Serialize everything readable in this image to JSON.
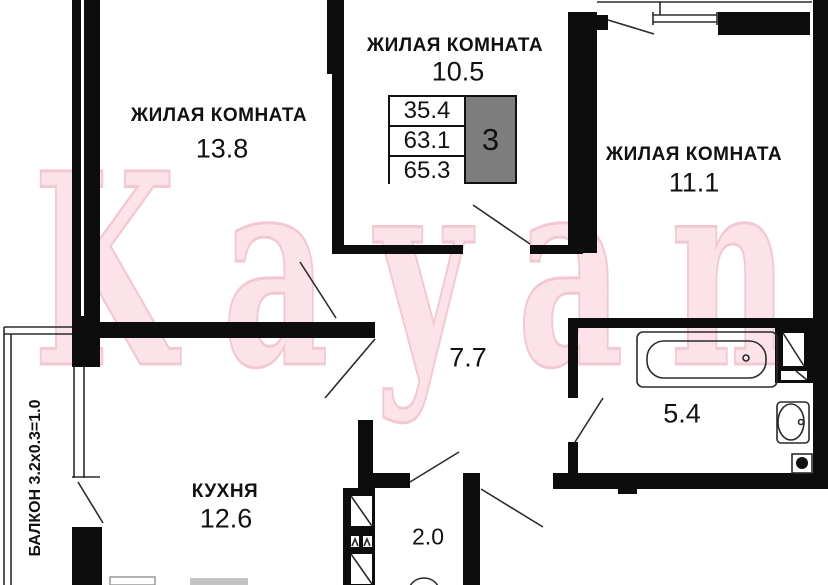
{
  "watermark": "Kayan",
  "rooms": [
    {
      "id": "living-1",
      "label": "ЖИЛАЯ КОМНАТА",
      "area": "13.8"
    },
    {
      "id": "living-2",
      "label": "ЖИЛАЯ КОМНАТА",
      "area": "10.5"
    },
    {
      "id": "living-3",
      "label": "ЖИЛАЯ КОМНАТА",
      "area": "11.1"
    },
    {
      "id": "hallway",
      "label": "",
      "area": "7.7"
    },
    {
      "id": "kitchen",
      "label": "КУХНЯ",
      "area": "12.6"
    },
    {
      "id": "bathroom",
      "label": "",
      "area": "5.4"
    },
    {
      "id": "wc",
      "label": "",
      "area": "2.0"
    }
  ],
  "balcony_label": "БАЛКОН 3.2x0.3=1.0",
  "info_table": {
    "rows": [
      "35.4",
      "63.1",
      "65.3"
    ],
    "room_count": "3"
  },
  "colors": {
    "wall": "#0d0d0d",
    "watermark_fill": "#fbe3e9",
    "watermark_outline": "#f2c8d2",
    "table_room_count_bg": "#7d7d7d"
  }
}
